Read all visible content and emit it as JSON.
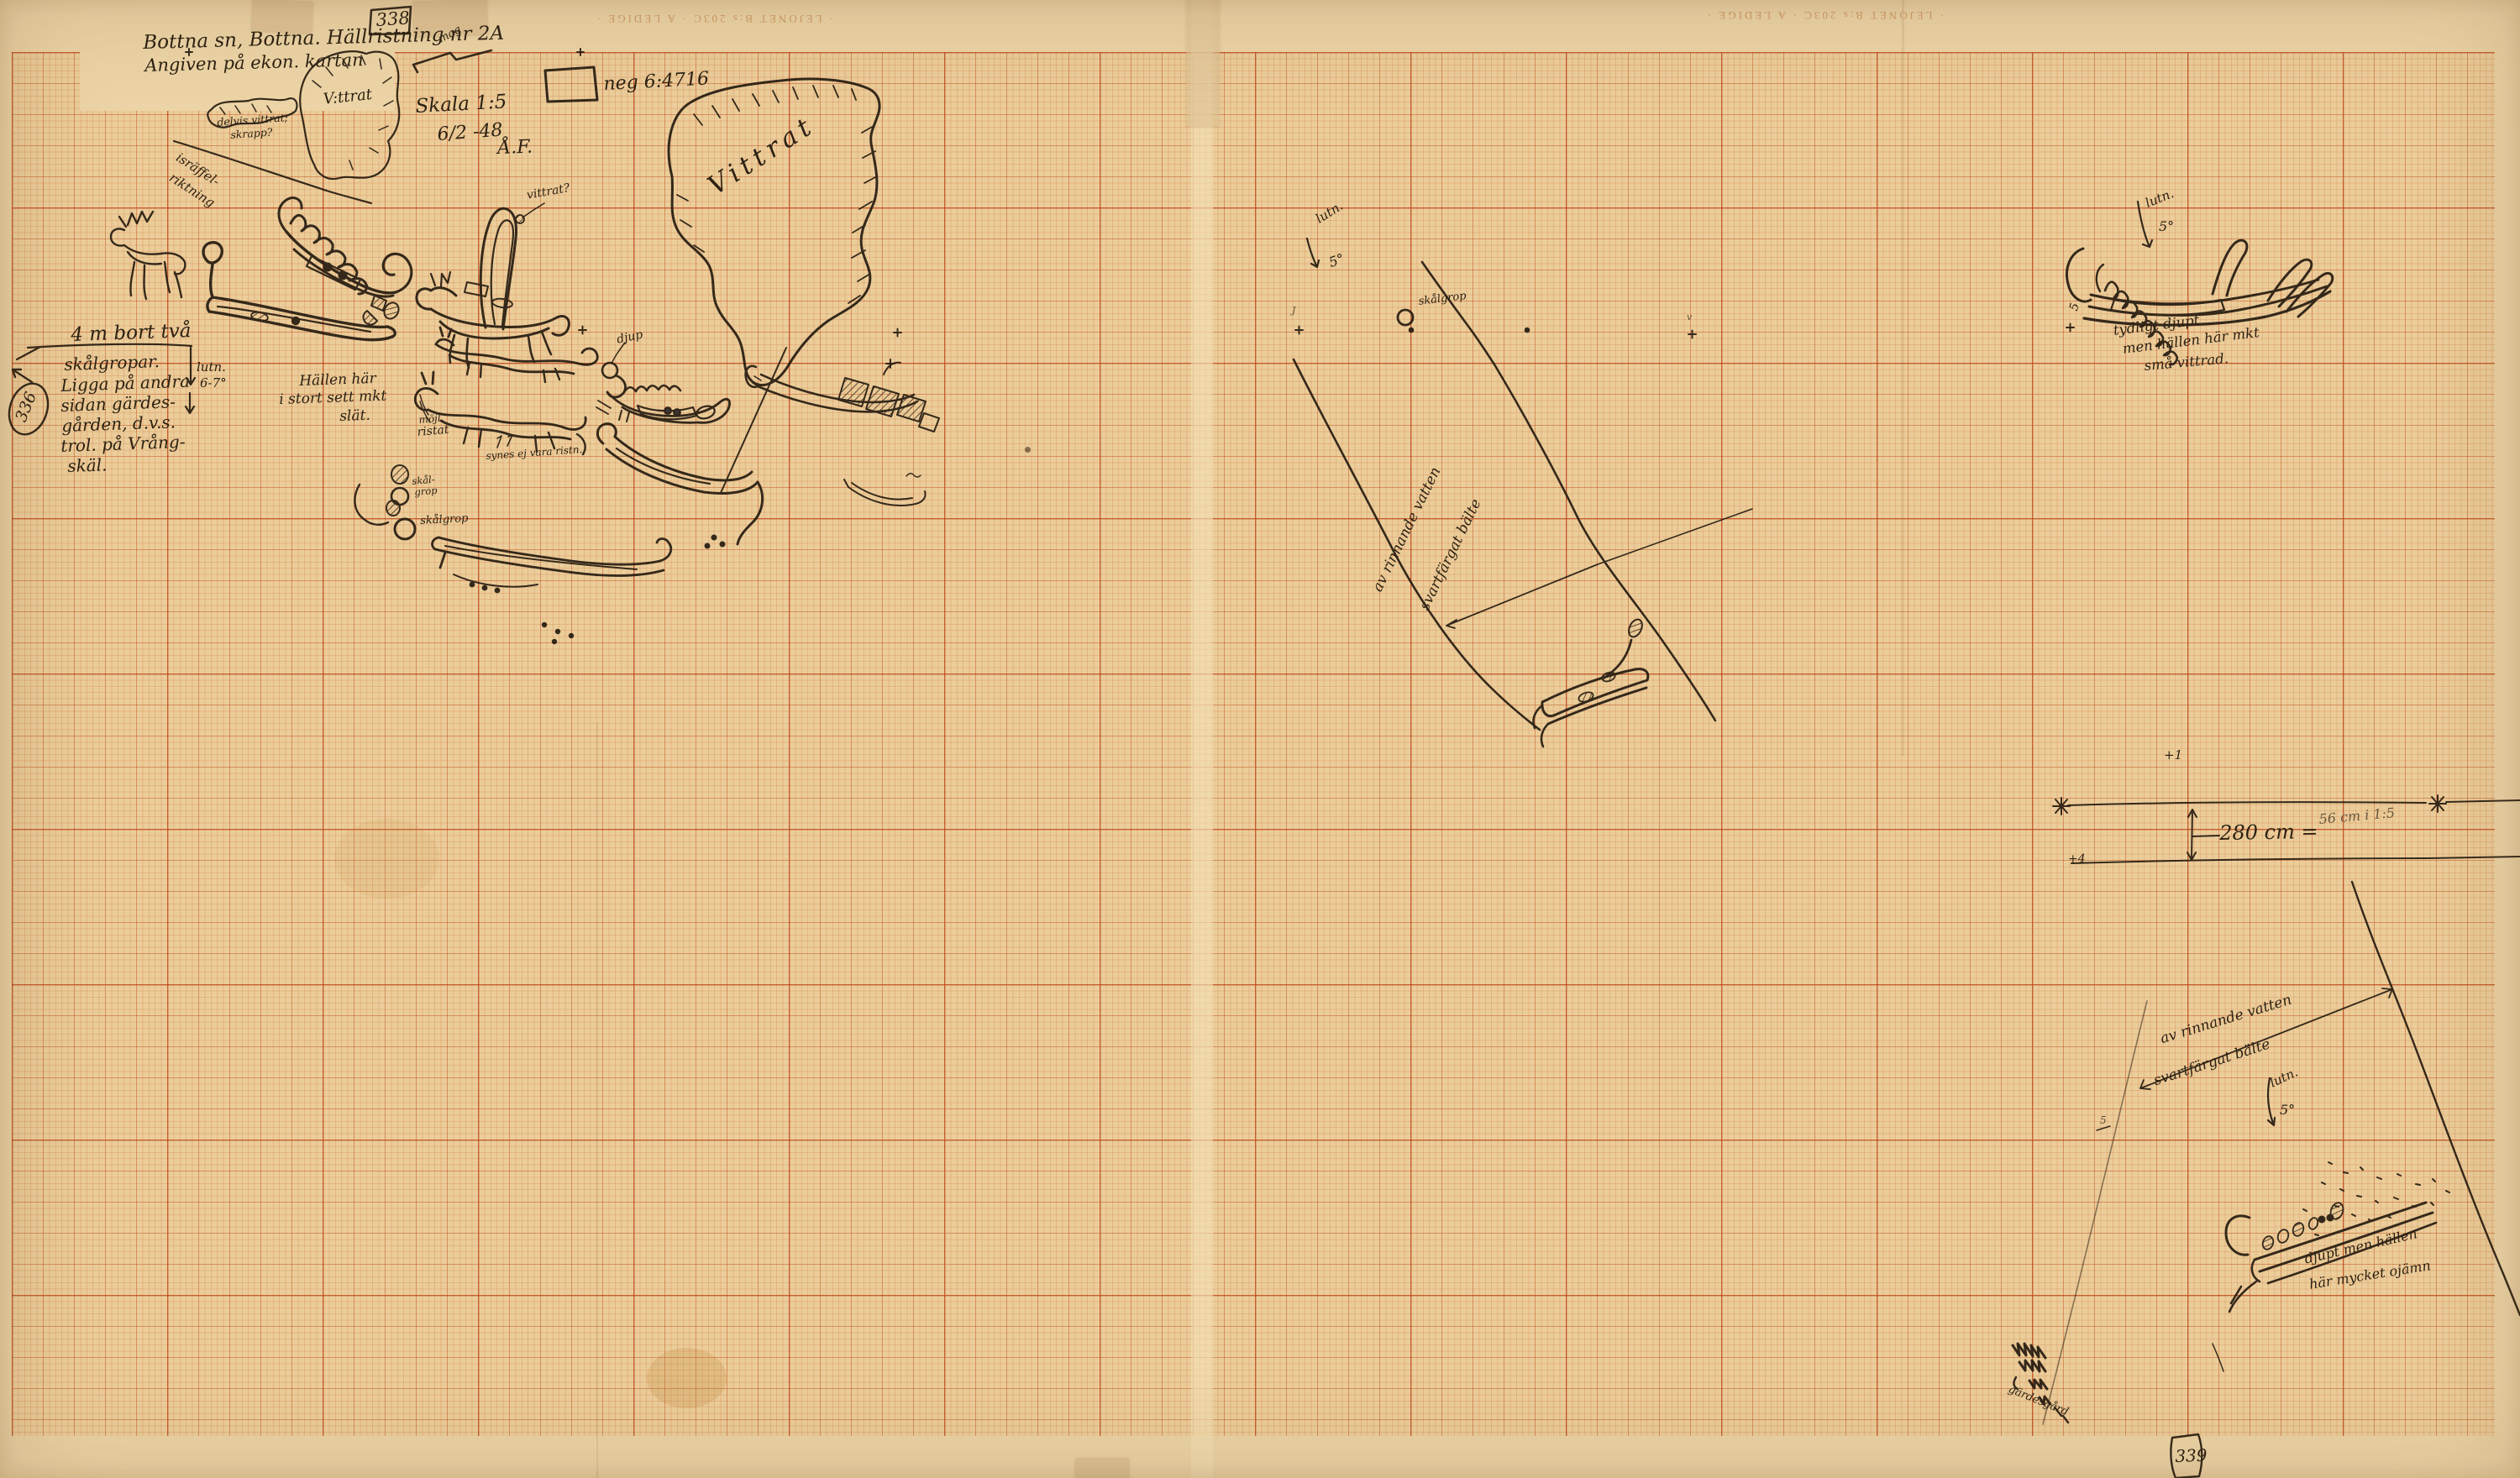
{
  "header": {
    "sheet_no": "338",
    "title": "Bottna sn, Bottna. Hällristning nr 2A",
    "subtitle": "Angiven på ekon. kartan",
    "north_label": "mag",
    "neg_label": "neg 6:4716",
    "scale": "Skala 1:5",
    "date": "6/2 -48",
    "initials": "Å.F."
  },
  "edge_print": {
    "text": "· LEJONET B:s 203C · A LEDIGE ·"
  },
  "left_note": {
    "heading": "4 m bort två",
    "lines": [
      "skålgropar.",
      "Ligga på andra",
      "sidan gärdes-",
      "gården, d.v.s.",
      "trol. på Vrång-",
      "skäl."
    ],
    "slope_label": "lutn.",
    "slope_value": "6-7°",
    "ref_no": "336"
  },
  "rock_labels": {
    "weathered_small": "V:ttrat",
    "partly1": "delvis vittrat;",
    "partly2": "skrapp?",
    "striation1": "isräffel-",
    "striation2": "riktning",
    "weathered_large": "Vittrat",
    "weathered_q": "vittrat?",
    "smooth1": "Hällen här",
    "smooth2": "i stort sett mkt",
    "smooth3": "slät.",
    "possibly1": "möjl.",
    "possibly2": "ristat",
    "seems": "synes ej vara ristn.",
    "deep": "djup",
    "cup_small1": "skål-",
    "cup_small2": "grop",
    "cup_large": "skålgrop"
  },
  "mid_panel": {
    "slope_label": "lutn.",
    "slope_value": "5°",
    "cup_label": "skålgrop",
    "belt1": "av rinnande vatten",
    "belt2": "svartfärgat bälte",
    "mark_left": "J",
    "mark_right": "v"
  },
  "right_top": {
    "slope_label": "lutn.",
    "slope_value": "5°",
    "note1": "tydligt djupt",
    "note2": "men hällen här mkt",
    "note3": "små vittrad.",
    "five": "5",
    "plus_one": "+1"
  },
  "measurement": {
    "value": "280 cm =",
    "converted": "56 cm i 1:5",
    "plus_four": "+4"
  },
  "right_bottom": {
    "belt1": "av rinnande vatten",
    "belt2": "svartfärgat bälte",
    "slope_label": "lutn.",
    "slope_value": "5°",
    "note1": "djupt men hällen",
    "note2": "här mycket ojämn",
    "fence": "gärdesgård",
    "five": "5"
  },
  "footer": {
    "sheet_no": "339"
  }
}
